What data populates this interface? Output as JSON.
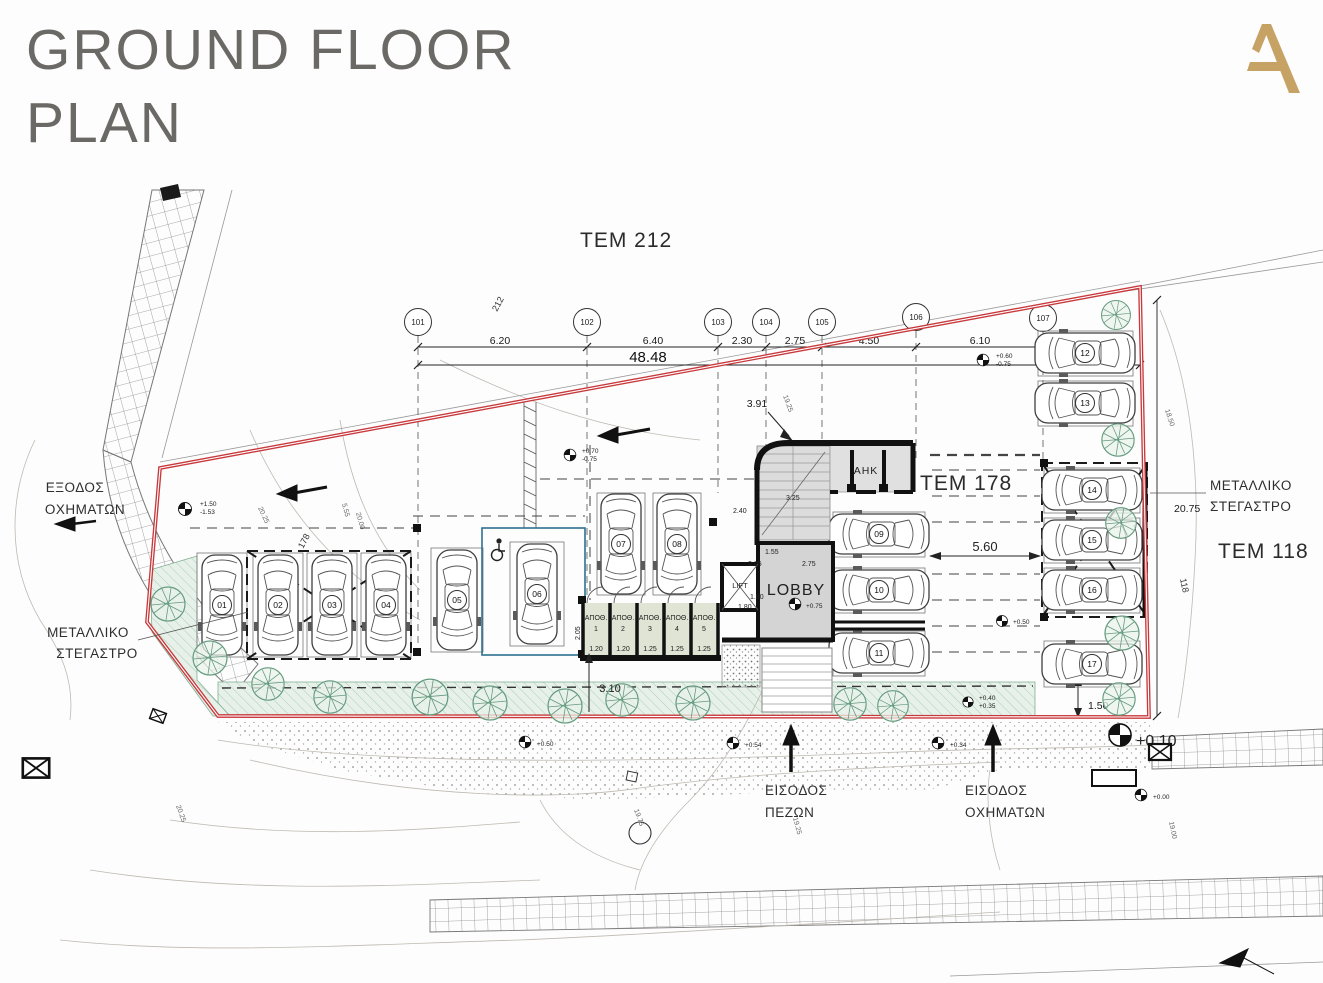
{
  "header": {
    "title_line1": "GROUND FLOOR",
    "title_line2": "PLAN",
    "logo_letter": "A"
  },
  "colors": {
    "accent_gold": "#c7a265",
    "boundary_red": "#c8393c",
    "title_gray": "#6b6965",
    "accessible_blue": "#2e7191"
  },
  "plots": {
    "tem212": "TEM 212",
    "tem178": "TEM 178",
    "tem118": "TEM 118"
  },
  "grid": {
    "b1": "101",
    "b2": "102",
    "b3": "103",
    "b4": "104",
    "b5": "105",
    "b6": "106",
    "b7": "107",
    "axis212": "212",
    "axis178": "178",
    "axis118": "118"
  },
  "dims": {
    "seg1": "6.20",
    "seg2": "6.40",
    "seg3": "2.30",
    "seg4": "2.75",
    "seg5": "4.50",
    "seg6": "6.10",
    "total": "48.48",
    "offset": "3.91",
    "aisle_width": "5.60",
    "right_total": "20.75",
    "right_diag": "18.50",
    "corner": "1.50",
    "strip": "3.10",
    "stair_width": "2.40",
    "stair_len": "3.25",
    "lobby_w": "2.05",
    "lobby_l": "2.75",
    "lobby_in": "1.55",
    "lift_w": "1.80",
    "lift_d": "1.80",
    "store_depth": "2.05",
    "store_w1": "1.20",
    "store_w2": "1.20",
    "store_w3": "1.25",
    "store_w4": "1.25",
    "store_w5": "1.25"
  },
  "levels": {
    "nw_a": "+1.50",
    "nw_b": "-1.53",
    "mid_a": "+0.70",
    "mid_b": "-0.75",
    "ne_a": "+0.60",
    "ne_b": "-0.75",
    "lobby": "+0.75",
    "aisle": "+0.50",
    "gate_a": "+0.40",
    "gate_b": "+0.35",
    "walk1": "+0.50",
    "walk2": "+0.54",
    "walk3": "+0.34",
    "corner": "+0.10",
    "street": "+0.00"
  },
  "contours": {
    "c1": "20.25",
    "c2": "5.55",
    "c3": "20.00",
    "c4": "19.25",
    "c5": "19.25",
    "c6": "19.75",
    "c7": "19.00",
    "c8": "20.25"
  },
  "labels": {
    "exit_line1": "ΕΞΟΔΟΣ",
    "exit_line2": "ΟΧΗΜΑΤΩΝ",
    "canopy_line1": "ΜΕΤΑΛΛΙΚΟ",
    "canopy_line2": "ΣΤΕΓΑΣΤΡΟ",
    "ped_line1": "ΕΙΣΟΔΟΣ",
    "ped_line2": "ΠΕΖΩΝ",
    "veh_line1": "ΕΙΣΟΔΟΣ",
    "veh_line2": "ΟΧΗΜΑΤΩΝ",
    "lobby": "LOBBY",
    "lift": "LIFT",
    "ahk": "ΑΗΚ",
    "store": "ΑΠΟΘ.",
    "s1": "1",
    "s2": "2",
    "s3": "3",
    "s4": "4",
    "s5": "5"
  },
  "parking": {
    "p01": "01",
    "p02": "02",
    "p03": "03",
    "p04": "04",
    "p05": "05",
    "p06": "06",
    "p07": "07",
    "p08": "08",
    "p09": "09",
    "p10": "10",
    "p11": "11",
    "p12": "12",
    "p13": "13",
    "p14": "14",
    "p15": "15",
    "p16": "16",
    "p17": "17"
  }
}
